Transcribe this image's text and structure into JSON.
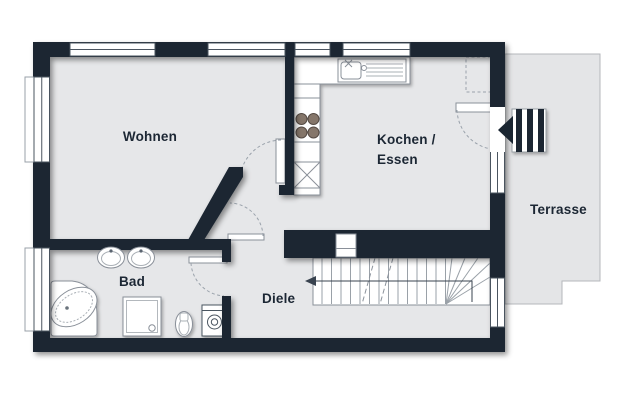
{
  "plan": {
    "type": "apartment-floor-plan",
    "labels": {
      "wohnen": "Wohnen",
      "kochen_line1": "Kochen /",
      "kochen_line2": "Essen",
      "terrasse": "Terrasse",
      "bad": "Bad",
      "diele": "Diele"
    },
    "colors": {
      "wall": "#1a2531",
      "floor": "#e6e7e9",
      "terrace": "#e4e5e7",
      "terrace_border": "#b4b7bb",
      "fixture_line": "#8a9099",
      "dash_line": "#9aa2ab",
      "burner": "#85766b",
      "walk_line": "#39434f",
      "label": "#1c2734",
      "white": "#ffffff"
    },
    "fixtures": {
      "kitchen": [
        "sink-unit",
        "stove-4-burners",
        "tall-cabinet-x",
        "counter"
      ],
      "bath": [
        "corner-bathtub",
        "double-washbasin",
        "shower",
        "toilet",
        "washing-machine"
      ],
      "circulation": [
        "staircase-14-treads-with-winders",
        "walk-line-arrow",
        "entrance-steps",
        "entrance-arrow"
      ],
      "doors": [
        "terrace-door",
        "wohnen-door",
        "diele-door",
        "bad-door"
      ],
      "windows_count": 8
    }
  }
}
